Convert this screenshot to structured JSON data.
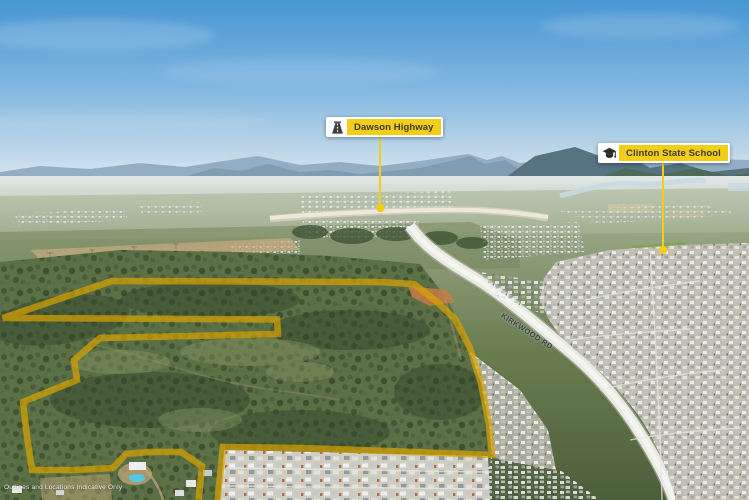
{
  "callouts": {
    "dawson": {
      "label": "Dawson Highway",
      "icon": "highway-icon"
    },
    "school": {
      "label": "Clinton State School",
      "icon": "graduation-cap-icon"
    }
  },
  "road": {
    "label": "KIRKWOOD RD"
  },
  "disclaimer": {
    "text": "Outlines and Locations Indicative Only"
  },
  "colors": {
    "callout_yellow": "#F2CF16",
    "site_outline_yellow": "#FFDF05",
    "leader_line_yellow": "#F2CF16",
    "callout_text": "#3A3A35",
    "road_label_text": "#3E434B",
    "disclaimer_text": "#FFFFFF",
    "sky_top": "#4896D4"
  }
}
